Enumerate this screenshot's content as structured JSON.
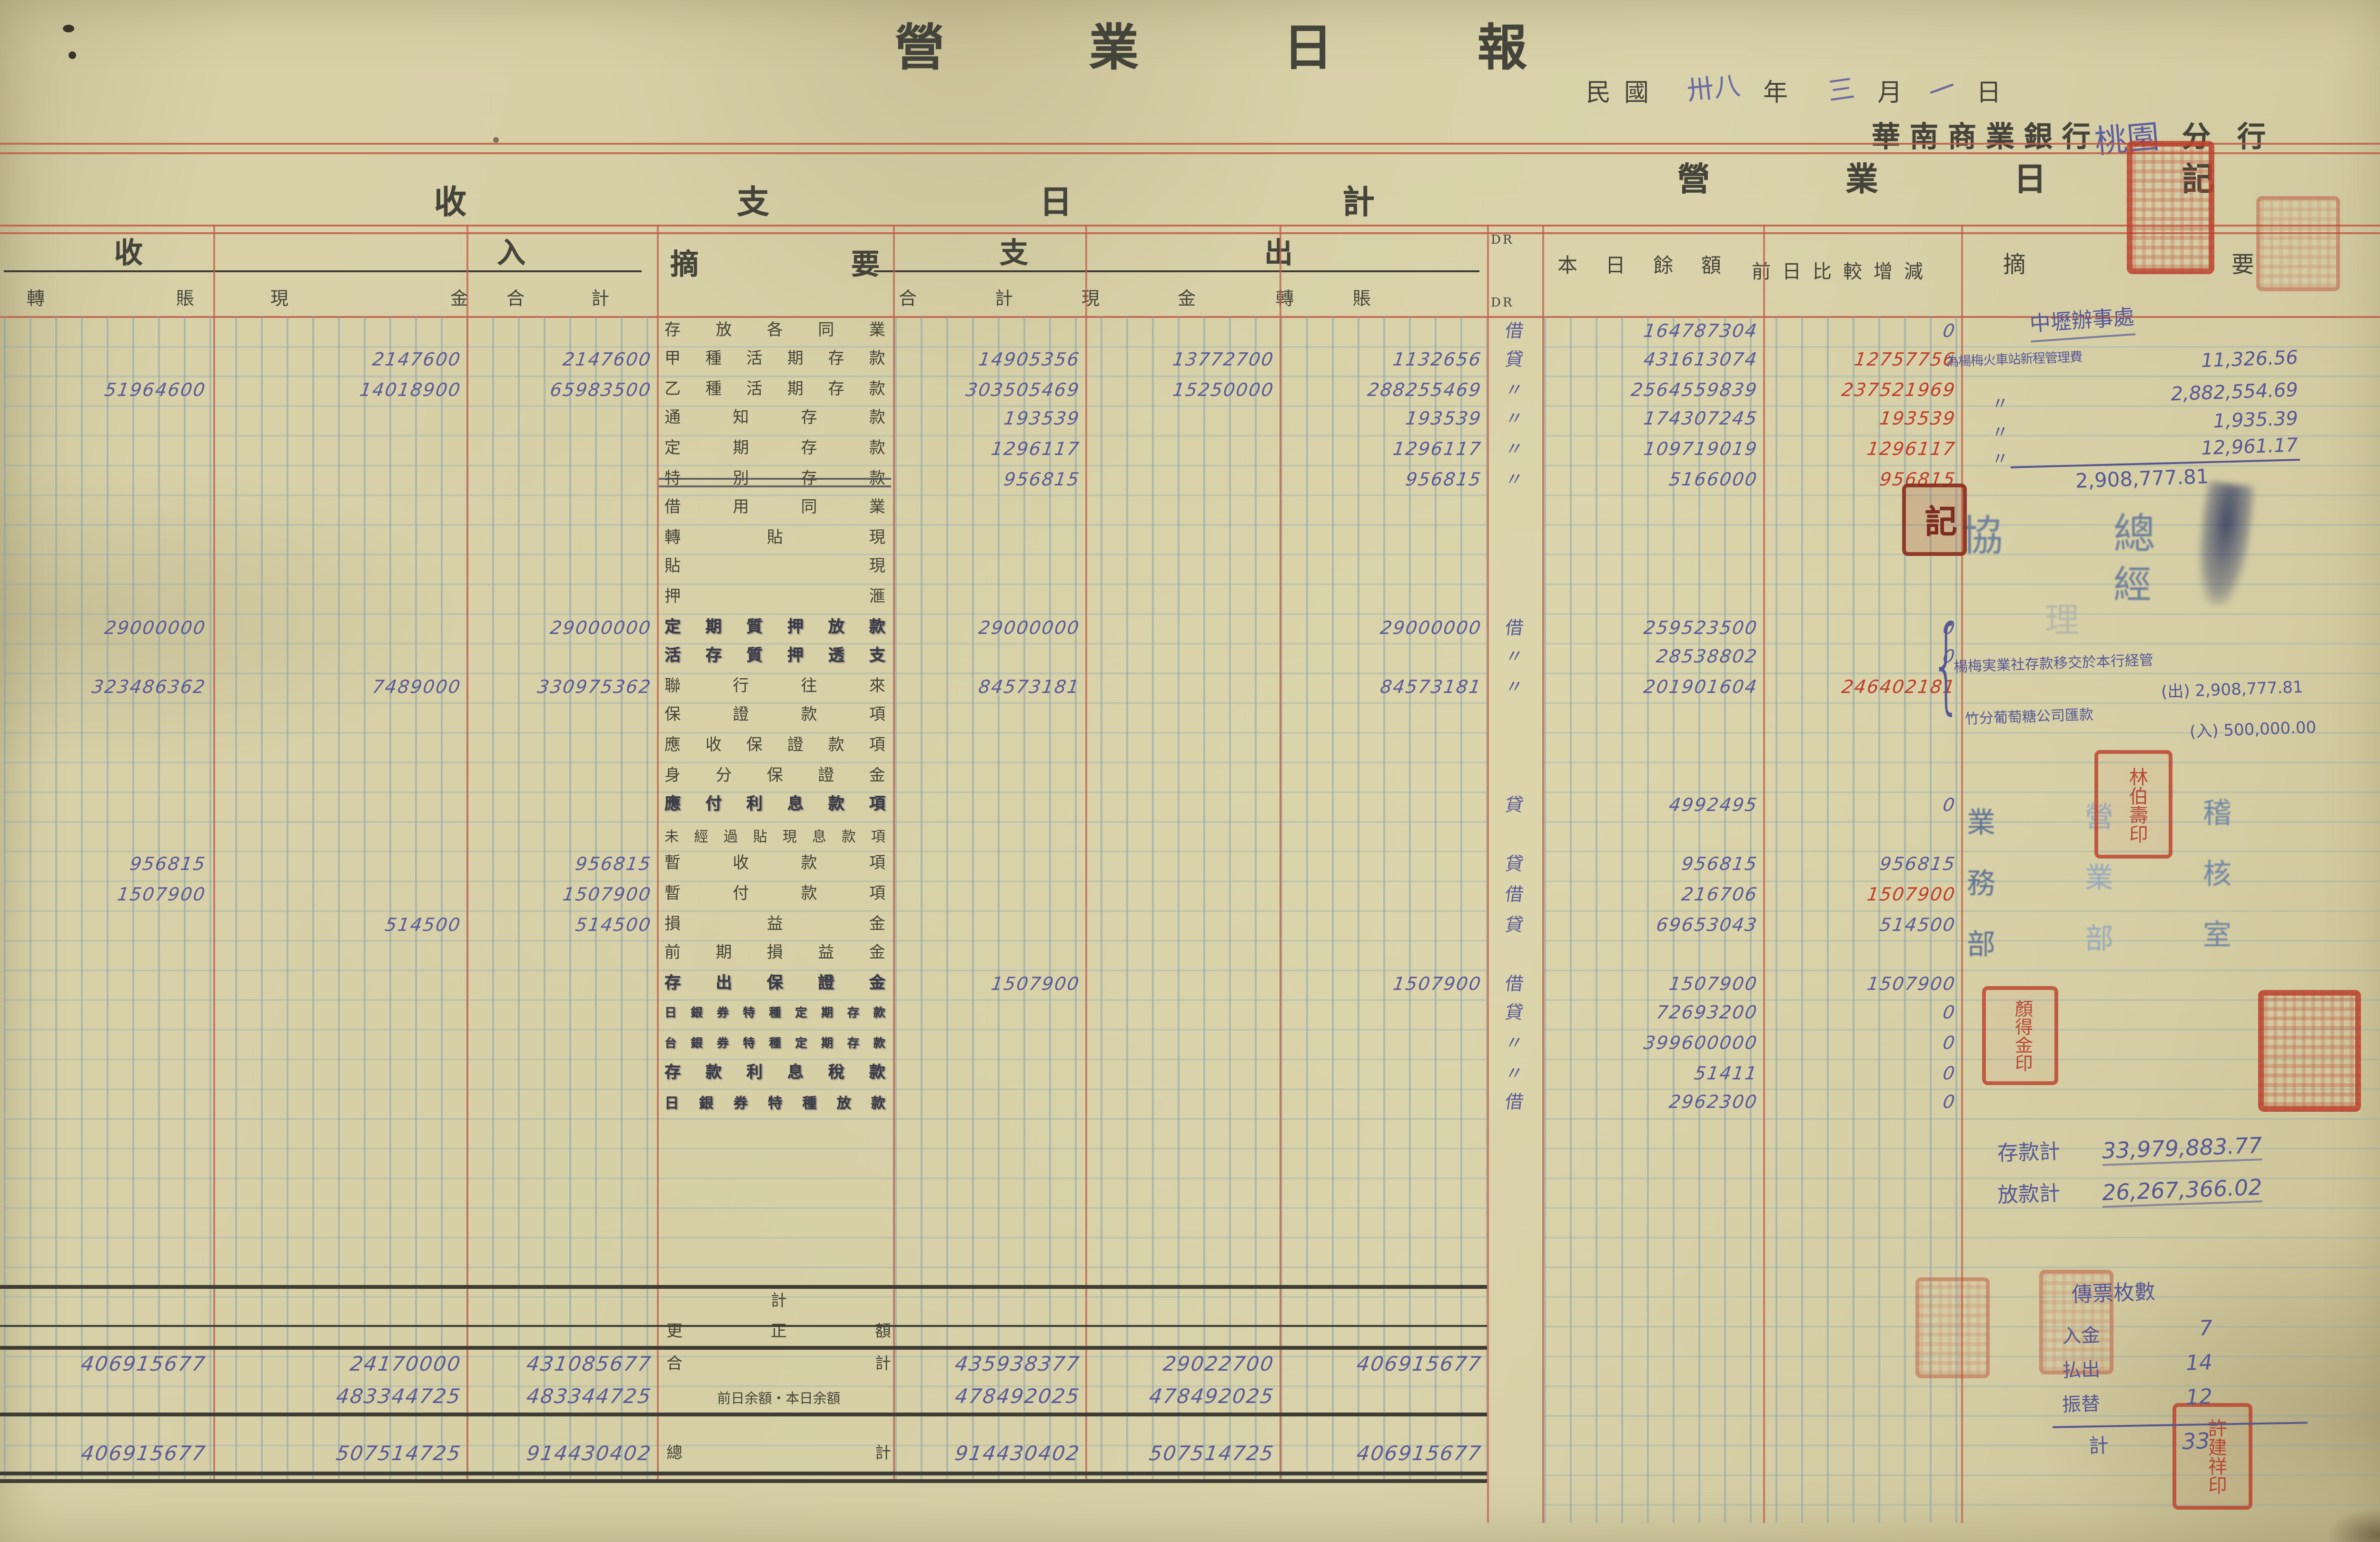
{
  "header": {
    "title": "營業日報",
    "era": "民國",
    "year_hand": "卅八",
    "year_suffix": "年",
    "month_hand": "三",
    "month_suffix": "月",
    "day_hand": "一",
    "day_suffix": "日",
    "bank": "華南商業銀行",
    "branch_hand": "桃園",
    "branch_suffix": "分行"
  },
  "left_section": {
    "title": "收支日計",
    "income_label": "收入",
    "desc_label": "摘要",
    "expense_label": "支出",
    "dr_top": "DR",
    "dr_bottom": "DR",
    "income_cols": [
      "轉賬",
      "現金",
      "合計"
    ],
    "expense_cols": [
      "合計",
      "現金",
      "轉賬"
    ]
  },
  "right_section": {
    "title": "營業日記",
    "balance_label": "本日餘額",
    "change_label": "前日比較增減",
    "note_label": "摘要"
  },
  "rows": [
    {
      "label": "存放各同業",
      "dr": "借",
      "bal": "164787304",
      "chg": "0"
    },
    {
      "label": "甲種活期存款",
      "ic": "2147600",
      "itot": "2147600",
      "et": "14905356",
      "ec": "13772700",
      "etr": "1132656",
      "dr": "貸",
      "bal": "431613074",
      "chg": "12757756",
      "chgRed": true
    },
    {
      "label": "乙種活期存款",
      "it": "51964600",
      "ic": "14018900",
      "itot": "65983500",
      "et": "303505469",
      "ec": "15250000",
      "etr": "288255469",
      "dr": "〃",
      "bal": "2564559839",
      "chg": "237521969",
      "chgRed": true
    },
    {
      "label": "通知存款",
      "et": "193539",
      "etr": "193539",
      "dr": "〃",
      "bal": "174307245",
      "chg": "193539",
      "chgRed": true
    },
    {
      "label": "定期存款",
      "et": "1296117",
      "etr": "1296117",
      "dr": "〃",
      "bal": "109719019",
      "chg": "1296117",
      "chgRed": true
    },
    {
      "label": "特別存款",
      "strike": true,
      "et": "956815",
      "etr": "956815",
      "dr": "〃",
      "bal": "5166000",
      "chg": "956815",
      "chgRed": true
    },
    {
      "label": "借用同業"
    },
    {
      "label": "轉貼現"
    },
    {
      "label": "貼現"
    },
    {
      "label": "押滙"
    },
    {
      "label": "定期質押放款",
      "style": "hand",
      "it": "29000000",
      "itot": "29000000",
      "et": "29000000",
      "etr": "29000000",
      "dr": "借",
      "bal": "259523500",
      "chg": "0"
    },
    {
      "label": "活存質押透支",
      "style": "hand",
      "dr": "〃",
      "bal": "28538802",
      "chg": "0"
    },
    {
      "label": "聯行往來",
      "it": "323486362",
      "ic": "7489000",
      "itot": "330975362",
      "et": "84573181",
      "etr": "84573181",
      "dr": "〃",
      "bal": "201901604",
      "chg": "246402181",
      "chgRed": true
    },
    {
      "label": "保證款項"
    },
    {
      "label": "應收保證款項"
    },
    {
      "label": "身分保證金"
    },
    {
      "label": "應付利息款項",
      "style": "hand",
      "dr": "貸",
      "bal": "4992495",
      "chg": "0"
    },
    {
      "label": "未經過貼現息款項"
    },
    {
      "label": "暫收款項",
      "it": "956815",
      "itot": "956815",
      "dr": "貸",
      "bal": "956815",
      "chg": "956815"
    },
    {
      "label": "暫付款項",
      "it": "1507900",
      "itot": "1507900",
      "dr": "借",
      "bal": "216706",
      "chg": "1507900",
      "chgRed": true
    },
    {
      "label": "損益金",
      "ic": "514500",
      "itot": "514500",
      "dr": "貸",
      "bal": "69653043",
      "chg": "514500"
    },
    {
      "label": "前期損益金"
    },
    {
      "label": "存出保證金",
      "style": "hand",
      "et": "1507900",
      "etr": "1507900",
      "dr": "借",
      "bal": "1507900",
      "chg": "1507900"
    },
    {
      "label": "日銀券特種定期存款",
      "style": "hand",
      "dr": "貸",
      "bal": "72693200",
      "chg": "0"
    },
    {
      "label": "台銀券特種定期存款",
      "style": "hand",
      "dr": "〃",
      "bal": "399600000",
      "chg": "0"
    },
    {
      "label": "存款利息稅款",
      "style": "hand",
      "dr": "〃",
      "bal": "51411",
      "chg": "0"
    },
    {
      "label": "日銀券特種放款",
      "style": "hand",
      "dr": "借",
      "bal": "2962300",
      "chg": "0"
    }
  ],
  "totals": [
    {
      "label": "計"
    },
    {
      "label": "更正額"
    },
    {
      "label": "合計",
      "it": "406915677",
      "ic": "24170000",
      "itot": "431085677",
      "et": "435938377",
      "ec": "29022700",
      "etr": "406915677"
    },
    {
      "label": "前日余額・本日余額",
      "ic": "483344725",
      "itot": "483344725",
      "et": "478492025",
      "ec": "478492025"
    },
    {
      "label": "總計",
      "it": "406915677",
      "ic": "507514725",
      "itot": "914430402",
      "et": "914430402",
      "ec": "507514725",
      "etr": "406915677"
    }
  ],
  "branch_notes": {
    "heading": "中壢辦事處",
    "line1_label": "為楊梅火車站新程管理費",
    "items": [
      {
        "mark": "",
        "value": "11,326.56"
      },
      {
        "mark": "〃",
        "value": "2,882,554.69"
      },
      {
        "mark": "〃",
        "value": "1,935.39"
      },
      {
        "mark": "〃",
        "value": "12,961.17"
      }
    ],
    "total": "2,908,777.81",
    "brace": "{",
    "note_a": "楊梅実業社存款移交於本行経管",
    "note_a_value": "(出) 2,908,777.81",
    "note_b": "竹分葡萄糖公司匯款",
    "note_b_value": "(入) 500,000.00"
  },
  "signatures": {
    "xie": "協",
    "zong": "總",
    "jing": "經",
    "li": "理",
    "dept1": "業務部",
    "dept2": "營業部",
    "dept3": "稽核室"
  },
  "stamps": {
    "ji": "記",
    "lin": "林伯壽印",
    "yan": "顏得金印",
    "xu": "許建祥印"
  },
  "deposit_summary": {
    "deposits_label": "存款計",
    "deposits_value": "33,979,883.77",
    "loans_label": "放款計",
    "loans_value": "26,267,366.02"
  },
  "vouchers": {
    "heading": "傳票枚數",
    "rows": [
      {
        "label": "入金",
        "value": "7"
      },
      {
        "label": "払出",
        "value": "14"
      },
      {
        "label": "振替",
        "value": "12"
      }
    ],
    "total_label": "計",
    "total_value": "33"
  },
  "colors": {
    "paper": "#d6cfa6",
    "ink_print": "#45443a",
    "ink_hand": "#5a5b98",
    "ink_red": "#bf3d2c",
    "grid_blue": "#9eb6c0",
    "grid_red": "#c2604c",
    "rule_black": "#3e3c33",
    "seal_red": "#ba402c"
  }
}
